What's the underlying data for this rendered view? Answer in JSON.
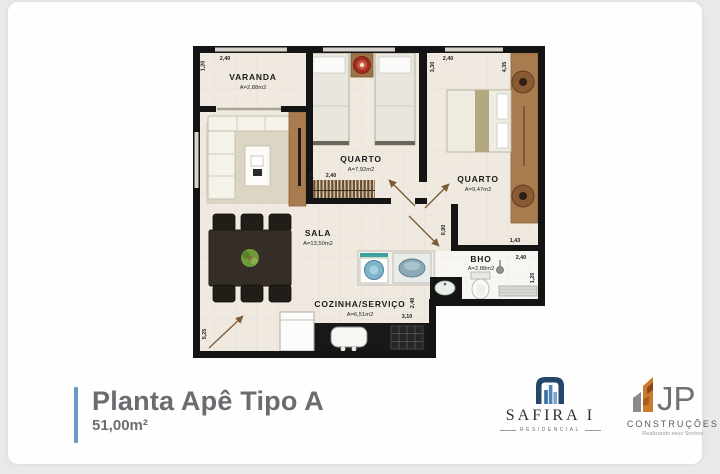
{
  "plan": {
    "rooms": [
      {
        "name": "VARANDA",
        "area": "A=2,88m2"
      },
      {
        "name": "QUARTO",
        "area": "A=7,92m2"
      },
      {
        "name": "QUARTO",
        "area": "A=9,47m2"
      },
      {
        "name": "SALA",
        "area": "A=13,50m2"
      },
      {
        "name": "COZINHA/SERVIÇO",
        "area": "A=6,51m2"
      },
      {
        "name": "BHO",
        "area": "A=2,88m2"
      }
    ],
    "dimensions": [
      {
        "edge": "varanda-left-vertical",
        "value": "1,20"
      },
      {
        "edge": "varanda-top",
        "value": "2,40"
      },
      {
        "edge": "quarto1-wardrobe-height",
        "value": "3,30"
      },
      {
        "edge": "quarto1-wardrobe-width",
        "value": "2,40"
      },
      {
        "edge": "quarto2-left-vertical",
        "value": "3,30"
      },
      {
        "edge": "quarto2-top",
        "value": "2,40"
      },
      {
        "edge": "quarto2-right-vertical",
        "value": "4,35"
      },
      {
        "edge": "quarto2-step-height",
        "value": "0,90"
      },
      {
        "edge": "quarto2-step-width",
        "value": "1,43"
      },
      {
        "edge": "bho-top",
        "value": "2,40"
      },
      {
        "edge": "bho-right-vertical",
        "value": "1,20"
      },
      {
        "edge": "cozinha-right-vertical",
        "value": "2,40"
      },
      {
        "edge": "cozinha-bottom",
        "value": "3,10"
      },
      {
        "edge": "sala-left-vertical",
        "value": "5,25"
      }
    ]
  },
  "footer": {
    "title": "Planta Apê Tipo A",
    "subtitle": "51,00m²"
  },
  "logos": {
    "safira": {
      "name": "SAFIRA I",
      "tagline": "RESIDENCIAL"
    },
    "jp": {
      "monogram": "JP",
      "name": "CONSTRUÇÕES",
      "tagline": "Realizando seus Sonhos"
    }
  },
  "colors": {
    "accent_bar": "#6b9ac9",
    "title_text": "#6a6d70",
    "wall": "#141414",
    "floor": "#efe9e0",
    "wood": "#a97c50",
    "water_blue": "#7db4c9",
    "safira_blue": "#24466b",
    "jp_orange": "#c97a2d"
  }
}
